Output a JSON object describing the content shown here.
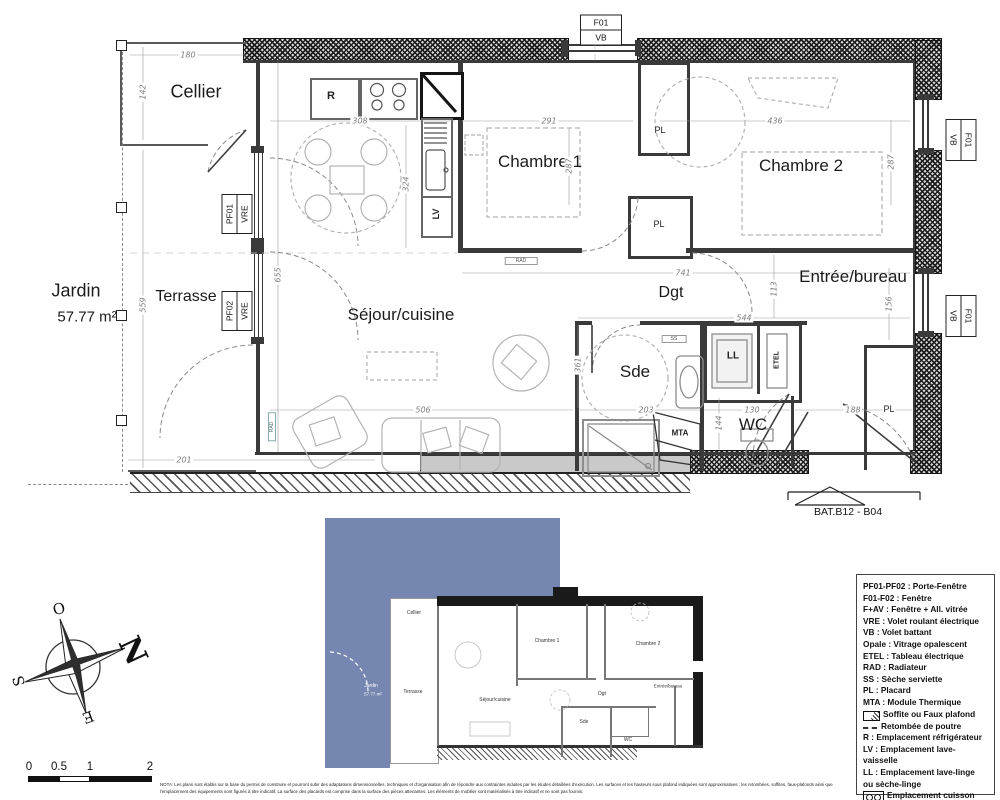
{
  "plan": {
    "rooms": {
      "cellier": "Cellier",
      "terrasse": "Terrasse",
      "jardin": "Jardin",
      "jardin_area": "57.77 m²",
      "sejour": "Séjour/cuisine",
      "chambre1": "Chambre 1",
      "chambre2": "Chambre 2",
      "dgt": "Dgt",
      "entree": "Entrée/bureau",
      "sde": "Sde",
      "wc": "WC"
    },
    "tags": {
      "r": "R",
      "lv": "LV",
      "ll": "LL",
      "etel": "ETEL",
      "pl": "PL",
      "mta": "MTA",
      "rad": "RAD",
      "ss": "SS"
    },
    "window_tags": {
      "f01": "F01",
      "vb": "VB",
      "pf01": "PF01",
      "pf02": "PF02",
      "vre": "VRE"
    },
    "dims": {
      "cellier_w": "180",
      "cellier_h": "142",
      "terrasse_h": "559",
      "terrasse_w": "201",
      "sejour_h": "655",
      "kitchen_w": "308",
      "kitchen_h": "324",
      "chambre1_w": "291",
      "chambre1_h": "287",
      "chambre2_w": "436",
      "chambre2_h": "287",
      "dgt_w": "741",
      "dgt_h": "113",
      "entree_h": "156",
      "entree_w": "544",
      "sde_h": "361",
      "sejour_w": "506",
      "sde_w": "203",
      "wc_w": "130",
      "wc_h": "144",
      "pl_w": "188"
    },
    "ref": "BAT.B12 - B04"
  },
  "legend": {
    "items": [
      "PF01-PF02 : Porte-Fenêtre",
      "F01-F02 : Fenêtre",
      "F+AV : Fenêtre + All. vitrée",
      "VRE : Volet roulant électrique",
      "VB : Volet battant",
      "Opale : Vitrage opalescent",
      "ETEL : Tableau électrique",
      "RAD : Radiateur",
      "SS : Sèche serviette",
      "PL : Placard",
      "MTA : Module Thermique",
      "Soffite ou Faux plafond",
      "Retombée de poutre",
      "R : Emplacement réfrigérateur",
      "LV : Emplacement lave-vaisselle",
      "LL : Emplacement lave-linge\nou sèche-linge",
      "Emplacement cuisson"
    ]
  },
  "compass": {
    "n": "N",
    "s": "S",
    "e": "E",
    "o": "O"
  },
  "scalebar": {
    "t0": "0",
    "t1": "0.5",
    "t2": "1",
    "t3": "2"
  },
  "nota": "NOTA: Les plans sont établis sur la base du permis de construire et pourront subir des adaptations dimensionnelles, techniques et d'organisation afin de répondre aux contraintes induites par les études détaillées d'exécution. Les surfaces et les hauteurs sous plafond indiquées sont approximatives ; les retombées, soffites, faux-plafonds ainsi que l'emplacement des équipements sont figurés à titre indicatif. La surface des placards est comprise dans la surface des pièces attenantes. Les éléments de mobilier sont matérialisés à titre indicatif et ne sont pas fournis."
}
